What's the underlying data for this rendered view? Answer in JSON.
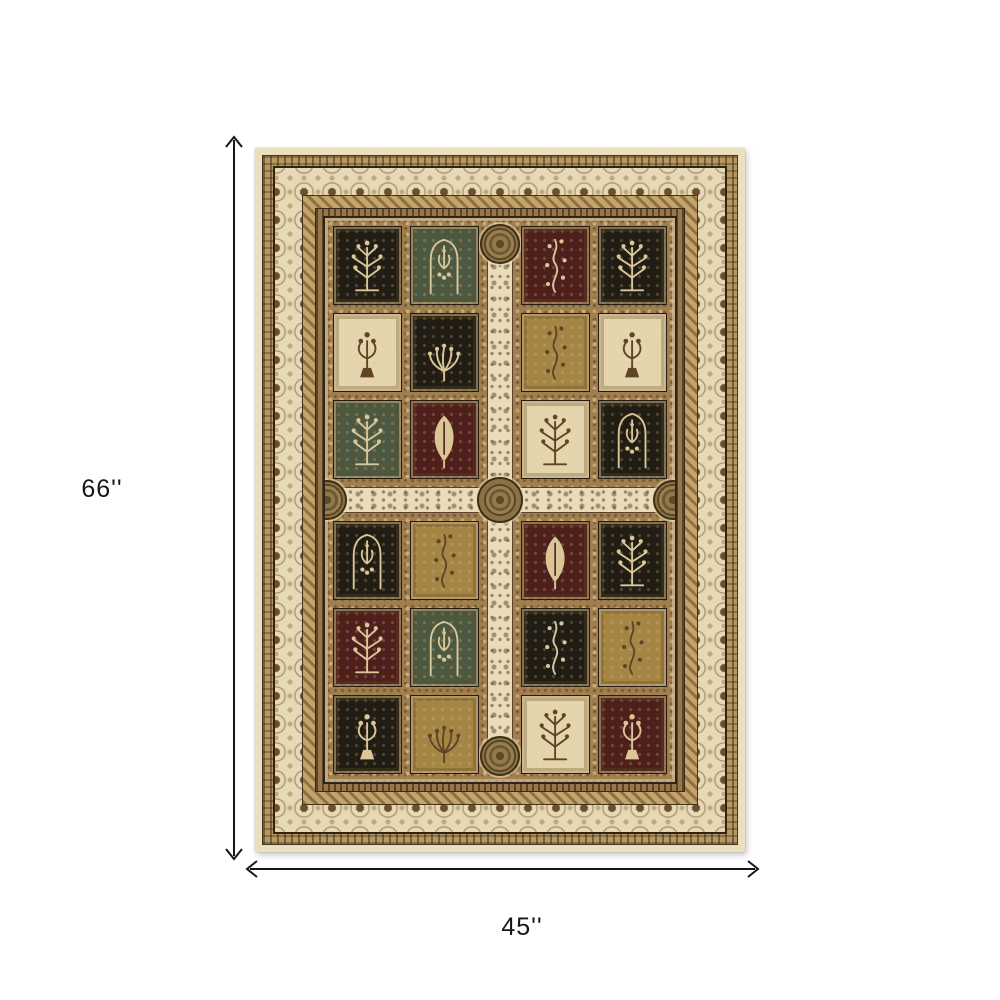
{
  "dimensions": {
    "height_label": "66''",
    "width_label": "45''"
  },
  "rug": {
    "panel_colors": {
      "black": "#211d14",
      "green": "#4d5840",
      "burgundy": "#4e1f1b",
      "ivory": "#e4d5ad",
      "tan": "#a58544"
    },
    "motif_on_dark": "#dbc697",
    "motif_on_light": "#5f4426",
    "accent_colors": {
      "outer_edge_cream": "#eadfbf",
      "guard_band_tan": "#b99860",
      "main_border_ivory": "#e7d9b5",
      "border_motif_brown": "#6d4f2f",
      "field_frame_tan": "#a07e4d",
      "cross_band_ivory": "#e9dcba",
      "medallion_olive": "#8f7a4a",
      "outline_dark": "#2f2516",
      "arrow_black": "#161616"
    },
    "panels": [
      [
        {
          "color": "black",
          "motif": "tree"
        },
        {
          "color": "green",
          "motif": "arch"
        },
        {
          "color": "burgundy",
          "motif": "floral"
        },
        {
          "color": "black",
          "motif": "tree"
        }
      ],
      [
        {
          "color": "ivory",
          "motif": "vase"
        },
        {
          "color": "black",
          "motif": "palm"
        },
        {
          "color": "tan",
          "motif": "floral"
        },
        {
          "color": "ivory",
          "motif": "vase"
        }
      ],
      [
        {
          "color": "green",
          "motif": "tree"
        },
        {
          "color": "burgundy",
          "motif": "leaf"
        },
        {
          "color": "ivory",
          "motif": "tree"
        },
        {
          "color": "black",
          "motif": "arch"
        }
      ],
      [
        {
          "color": "black",
          "motif": "arch"
        },
        {
          "color": "tan",
          "motif": "floral"
        },
        {
          "color": "burgundy",
          "motif": "leaf"
        },
        {
          "color": "black",
          "motif": "tree"
        }
      ],
      [
        {
          "color": "burgundy",
          "motif": "tree"
        },
        {
          "color": "green",
          "motif": "arch"
        },
        {
          "color": "black",
          "motif": "floral"
        },
        {
          "color": "tan",
          "motif": "floral"
        }
      ],
      [
        {
          "color": "black",
          "motif": "vase"
        },
        {
          "color": "tan",
          "motif": "palm"
        },
        {
          "color": "ivory",
          "motif": "tree"
        },
        {
          "color": "burgundy",
          "motif": "vase"
        }
      ]
    ]
  }
}
